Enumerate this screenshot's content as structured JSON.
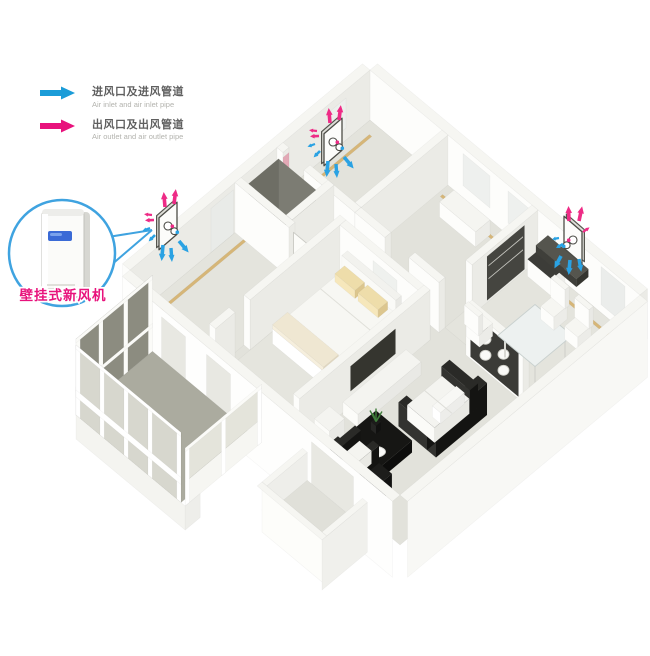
{
  "legend": {
    "items": [
      {
        "id": "air-inlet",
        "zh": "进风口及进风管道",
        "en": "Air inlet and air inlet pipe",
        "color": "#1b9cd8"
      },
      {
        "id": "air-outlet",
        "zh": "出风口及出风管道",
        "en": "Air outlet and air outlet pipe",
        "color": "#e8127c"
      }
    ]
  },
  "callout": {
    "label": "壁挂式新风机",
    "label_color": "#e8127c",
    "circle_color": "#3fa3e0"
  },
  "scene": {
    "units": [
      {
        "id": "wall-unit-left-bedroom",
        "room": "left bedroom exterior wall"
      },
      {
        "id": "wall-unit-top-room",
        "room": "top room exterior wall"
      },
      {
        "id": "wall-unit-dining",
        "room": "dining room exterior wall"
      }
    ],
    "arrow_colors": {
      "inlet": "#2aa2e3",
      "outlet": "#ee2b86"
    }
  }
}
